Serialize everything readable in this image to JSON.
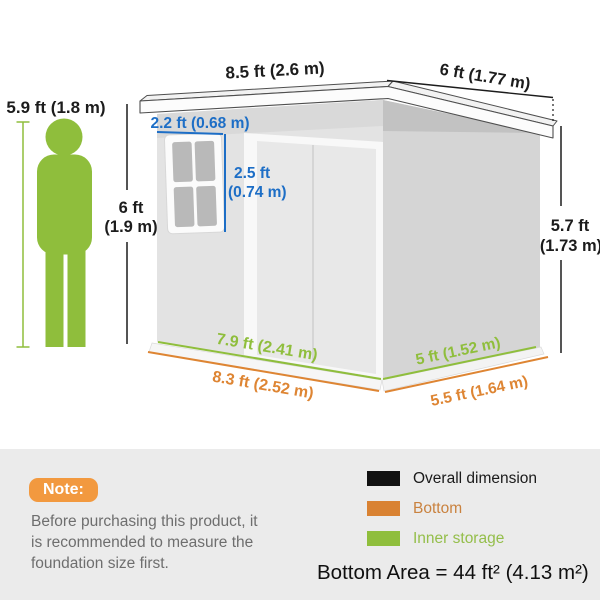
{
  "colors": {
    "green": "#8FBE3C",
    "orange": "#DE8533",
    "blue": "#1D6EC6",
    "dark": "#1C1C1C",
    "note_badge_bg": "#F2993F",
    "note_text": "#6E6E6E",
    "panel_bg": "#EBEBEB"
  },
  "diagram": {
    "person_height_label": "5.9 ft (1.8 m)",
    "roof_front_width": "8.5 ft (2.6 m)",
    "roof_side_depth": "6 ft (1.77 m)",
    "window_width": "2.2 ft (0.68 m)",
    "window_height_line1": "2.5 ft",
    "window_height_line2": "(0.74 m)",
    "front_height_line1": "6 ft",
    "front_height_line2": "(1.9 m)",
    "rear_height_line1": "5.7 ft",
    "rear_height_line2": "(1.73 m)",
    "inner_front_width": "7.9 ft (2.41 m)",
    "bottom_front_width": "8.3 ft (2.52 m)",
    "inner_side_depth": "5 ft (1.52 m)",
    "bottom_side_depth": "5.5 ft (1.64 m)"
  },
  "note": {
    "badge": "Note:",
    "lines": [
      "Before purchasing this product, it",
      "is recommended to measure the",
      "foundation size first."
    ]
  },
  "legend": {
    "items": [
      {
        "label": "Overall dimension",
        "swatch": "#111111",
        "label_color": "#1A1A1A"
      },
      {
        "label": "Bottom",
        "swatch": "#D98232",
        "label_color": "#C9823F"
      },
      {
        "label": "Inner storage",
        "swatch": "#8FBE3C",
        "label_color": "#94BE4A"
      }
    ],
    "bottom_area": "Bottom Area = 44 ft² (4.13 m²)"
  }
}
